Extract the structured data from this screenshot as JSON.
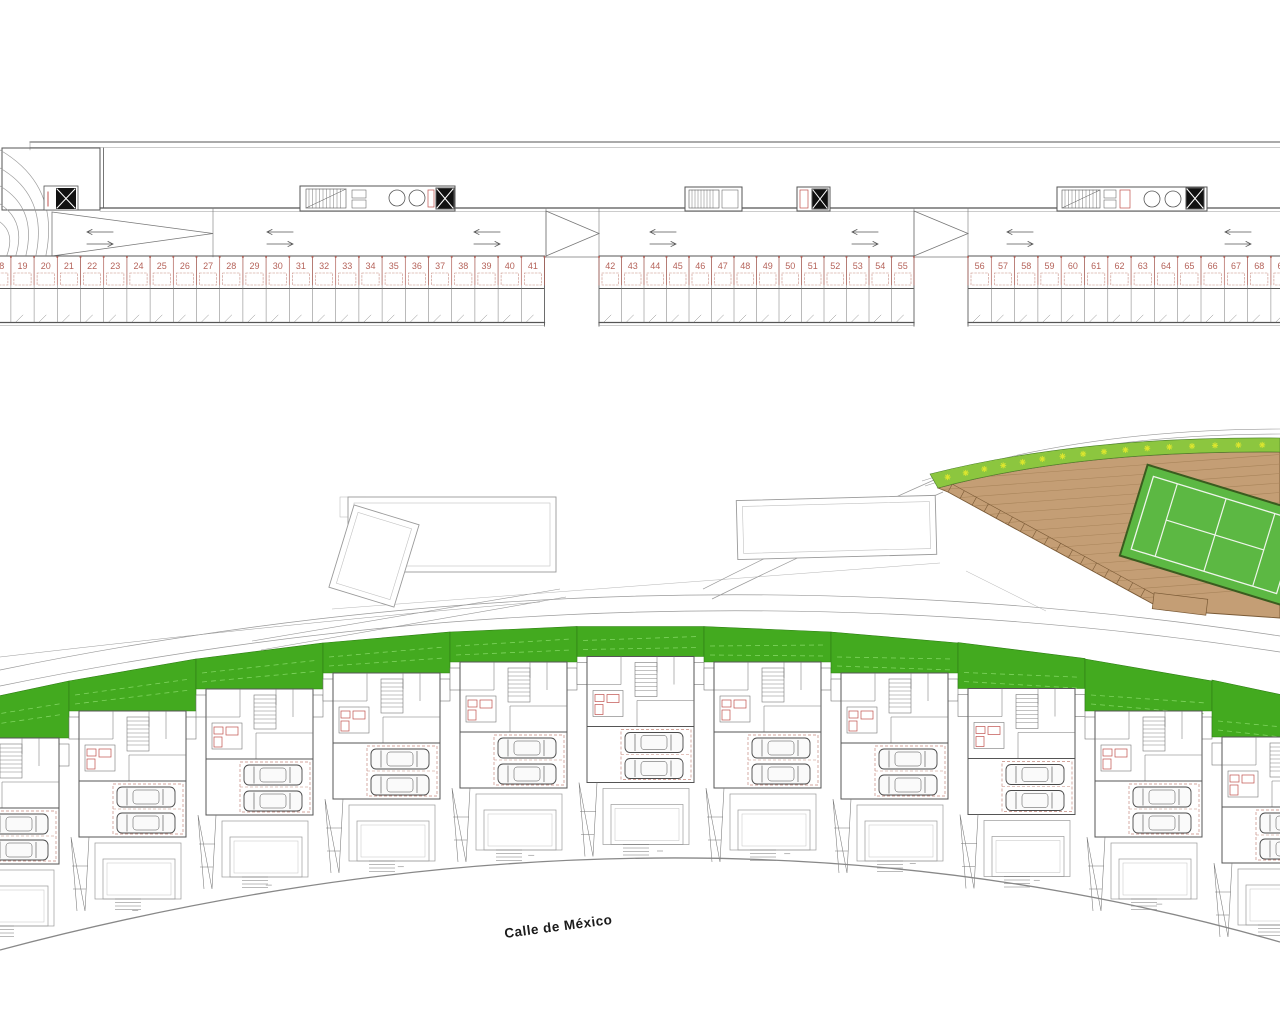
{
  "drawing": {
    "kind": "residential development site plan with basement parking level",
    "street_label": "Calle de México"
  },
  "colors": {
    "roof_green": "#43aa1f",
    "roof_green_light": "#7fd45f",
    "court_green": "#5cb843",
    "plant_strip_green": "#8cc63f",
    "plant_glyph": "#dce62e",
    "deck_brown": "#c49e75",
    "deck_plank_line": "#a8845a",
    "deck_edge_brown": "#7a5a36",
    "accent_red": "#c0504d",
    "stall_number_red": "#b5635a",
    "stall_dash_red": "#c6897f",
    "line_dark": "#555",
    "line_mid": "#777",
    "line_light": "#9a9a9a"
  },
  "parking": {
    "sections": [
      {
        "first": 18,
        "last": 41,
        "x0": -12.3,
        "stall_w": 23.2
      },
      {
        "first": 42,
        "last": 55,
        "x0": 599,
        "stall_w": 22.5
      },
      {
        "first": 56,
        "last": 69,
        "x0": 968,
        "stall_w": 23.3
      }
    ],
    "lane_arrows_x": [
      100,
      280,
      487,
      663,
      865,
      1020,
      1238
    ]
  },
  "site": {
    "street_label": "Calle de México",
    "plants_count": 16,
    "houses": [
      {
        "x": -58,
        "y": 708,
        "s": -27
      },
      {
        "x": 69,
        "y": 681,
        "s": -22
      },
      {
        "x": 196,
        "y": 659,
        "s": -16
      },
      {
        "x": 323,
        "y": 643,
        "s": -11
      },
      {
        "x": 450,
        "y": 632,
        "s": -5.5
      },
      {
        "x": 577,
        "y": 626.5,
        "s": 0
      },
      {
        "x": 704,
        "y": 626.5,
        "s": 5.5
      },
      {
        "x": 831,
        "y": 632,
        "s": 11
      },
      {
        "x": 958,
        "y": 642.5,
        "s": 16
      },
      {
        "x": 1085,
        "y": 659,
        "s": 22
      },
      {
        "x": 1212,
        "y": 680,
        "s": 27
      }
    ]
  }
}
